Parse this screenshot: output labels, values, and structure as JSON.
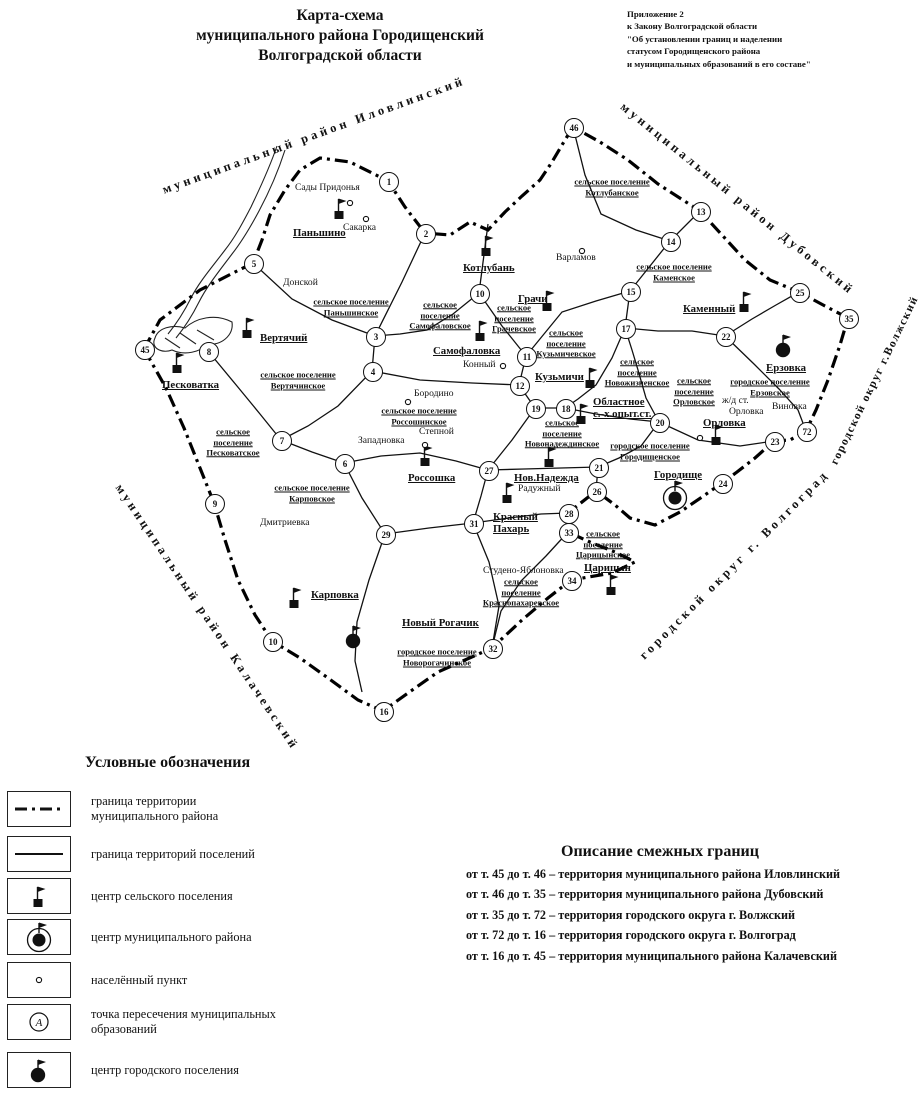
{
  "title": {
    "lines": [
      "Карта-схема",
      "муниципального района Городищенский",
      "Волгоградской области"
    ]
  },
  "annotation": {
    "lines": [
      "Приложение 2",
      "к Закону Волгоградской области",
      "\"Об установлении границ и наделении",
      "статусом Городищенского района",
      "и муниципальных образований в его составе\""
    ]
  },
  "map": {
    "neighbors": [
      {
        "label": "муниципальный район Иловлинский",
        "x": 163,
        "y": 183,
        "angle": -20,
        "small": false
      },
      {
        "label": "муниципальный район Дубовский",
        "x": 622,
        "y": 98,
        "angle": 39,
        "small": false
      },
      {
        "label": "городской округ г.Волжский",
        "x": 834,
        "y": 458,
        "angle": -64,
        "small": true
      },
      {
        "label": "городской округ г. Волгоград",
        "x": 642,
        "y": 650,
        "angle": -45,
        "small": false
      },
      {
        "label": "муниципальный район Калачевский",
        "x": 118,
        "y": 478,
        "angle": 56,
        "small": false
      }
    ],
    "area_labels": [
      {
        "text": "сельское поселение\nПаньшинское",
        "cx": 351,
        "cy": 307
      },
      {
        "text": "сельское\nпоселение\nСамофаловское",
        "cx": 440,
        "cy": 315
      },
      {
        "text": "сельское поселение\nКотлубанское",
        "cx": 612,
        "cy": 187
      },
      {
        "text": "сельское\nпоселение\nГрачевское",
        "cx": 514,
        "cy": 318
      },
      {
        "text": "сельское поселение\nКаменское",
        "cx": 674,
        "cy": 272
      },
      {
        "text": "сельское поселение\nВертячинское",
        "cx": 298,
        "cy": 380
      },
      {
        "text": "сельское\nпоселение\nПесковатское",
        "cx": 233,
        "cy": 442
      },
      {
        "text": "сельское поселение\nРоссошинское",
        "cx": 419,
        "cy": 416
      },
      {
        "text": "сельское\nпоселение\nКузьмичевское",
        "cx": 566,
        "cy": 343
      },
      {
        "text": "сельское\nпоселение\nНовожизненское",
        "cx": 637,
        "cy": 372
      },
      {
        "text": "сельское\nпоселение\nОрловское",
        "cx": 694,
        "cy": 391
      },
      {
        "text": "городское поселение\nЕрзовское",
        "cx": 770,
        "cy": 387
      },
      {
        "text": "сельское\nпоселение\nНовонадеждинское",
        "cx": 562,
        "cy": 433
      },
      {
        "text": "городское поселение\nГородищенское",
        "cx": 650,
        "cy": 451
      },
      {
        "text": "сельское поселение\nКарповское",
        "cx": 312,
        "cy": 493
      },
      {
        "text": "сельское\nпоселение\nКраснопахаревское",
        "cx": 521,
        "cy": 592
      },
      {
        "text": "сельское\nпоселение\nЦарицынское",
        "cx": 603,
        "cy": 544
      },
      {
        "text": "городское поселение\nНоворогачинское",
        "cx": 437,
        "cy": 657
      }
    ],
    "place_labels": [
      {
        "kind": "center",
        "text": "Паньшино",
        "x": 293,
        "y": 227
      },
      {
        "kind": "center",
        "text": "Котлубань",
        "x": 463,
        "y": 262
      },
      {
        "kind": "center",
        "text": "Грачи",
        "x": 518,
        "y": 293
      },
      {
        "kind": "center",
        "text": "Самофаловка",
        "x": 433,
        "y": 345
      },
      {
        "kind": "center",
        "text": "Вертячий",
        "x": 260,
        "y": 332
      },
      {
        "kind": "center",
        "text": "Песковатка",
        "x": 162,
        "y": 379
      },
      {
        "kind": "center",
        "text": "Каменный",
        "x": 683,
        "y": 303
      },
      {
        "kind": "center",
        "text": "Россошка",
        "x": 408,
        "y": 472
      },
      {
        "kind": "center",
        "text": "Кузьмичи",
        "x": 535,
        "y": 371
      },
      {
        "kind": "center",
        "text": "Областное\nс.-х.опыт.ст.",
        "x": 593,
        "y": 396
      },
      {
        "kind": "center",
        "text": "Орловка",
        "x": 703,
        "y": 417
      },
      {
        "kind": "center",
        "text": "Нов.Надежда",
        "x": 514,
        "y": 472
      },
      {
        "kind": "center",
        "text": "Красный\nПахарь",
        "x": 493,
        "y": 511
      },
      {
        "kind": "center",
        "text": "Карповка",
        "x": 311,
        "y": 589
      },
      {
        "kind": "center",
        "text": "Царицын",
        "x": 584,
        "y": 562
      },
      {
        "kind": "center",
        "text": "Городище",
        "x": 654,
        "y": 469
      },
      {
        "kind": "center",
        "text": "Ерзовка",
        "x": 766,
        "y": 362
      },
      {
        "kind": "center",
        "text": "Новый Рогачик",
        "x": 402,
        "y": 617
      },
      {
        "kind": "village",
        "text": "Сады Придонья",
        "x": 295,
        "y": 183
      },
      {
        "kind": "village",
        "text": "Сакарка",
        "x": 343,
        "y": 223
      },
      {
        "kind": "village",
        "text": "Донской",
        "x": 283,
        "y": 278
      },
      {
        "kind": "village",
        "text": "Варламов",
        "x": 556,
        "y": 253
      },
      {
        "kind": "village",
        "text": "Конный",
        "x": 463,
        "y": 360
      },
      {
        "kind": "village",
        "text": "Бородино",
        "x": 414,
        "y": 389
      },
      {
        "kind": "village",
        "text": "Западновка",
        "x": 358,
        "y": 436
      },
      {
        "kind": "village",
        "text": "Степной",
        "x": 419,
        "y": 427
      },
      {
        "kind": "village",
        "text": "Дмитриевка",
        "x": 260,
        "y": 518
      },
      {
        "kind": "village",
        "text": "Радужный",
        "x": 518,
        "y": 484
      },
      {
        "kind": "village",
        "text": "Студено-Яблоновка",
        "x": 483,
        "y": 566
      },
      {
        "kind": "village",
        "text": "Виновка",
        "x": 772,
        "y": 402
      },
      {
        "kind": "village",
        "text": "ж/д ст.",
        "x": 722,
        "y": 396
      },
      {
        "kind": "village",
        "text": "Орловка",
        "x": 729,
        "y": 407
      }
    ],
    "points": [
      {
        "n": "1",
        "x": 388,
        "y": 181
      },
      {
        "n": "2",
        "x": 425,
        "y": 233
      },
      {
        "n": "5",
        "x": 253,
        "y": 263
      },
      {
        "n": "3",
        "x": 375,
        "y": 336
      },
      {
        "n": "4",
        "x": 372,
        "y": 371
      },
      {
        "n": "45",
        "x": 144,
        "y": 349
      },
      {
        "n": "8",
        "x": 208,
        "y": 351
      },
      {
        "n": "7",
        "x": 281,
        "y": 440
      },
      {
        "n": "6",
        "x": 344,
        "y": 463
      },
      {
        "n": "9",
        "x": 214,
        "y": 503
      },
      {
        "n": "29",
        "x": 385,
        "y": 534
      },
      {
        "n": "10",
        "x": 272,
        "y": 641
      },
      {
        "n": "16",
        "x": 383,
        "y": 711
      },
      {
        "n": "32",
        "x": 492,
        "y": 648
      },
      {
        "n": "31",
        "x": 473,
        "y": 523
      },
      {
        "n": "27",
        "x": 488,
        "y": 470
      },
      {
        "n": "46",
        "x": 573,
        "y": 127
      },
      {
        "n": "13",
        "x": 700,
        "y": 211
      },
      {
        "n": "14",
        "x": 670,
        "y": 241
      },
      {
        "n": "15",
        "x": 630,
        "y": 291
      },
      {
        "n": "17",
        "x": 625,
        "y": 328
      },
      {
        "n": "10",
        "x": 479,
        "y": 293
      },
      {
        "n": "11",
        "x": 526,
        "y": 356
      },
      {
        "n": "12",
        "x": 519,
        "y": 385
      },
      {
        "n": "19",
        "x": 535,
        "y": 408
      },
      {
        "n": "18",
        "x": 565,
        "y": 408
      },
      {
        "n": "20",
        "x": 659,
        "y": 422
      },
      {
        "n": "21",
        "x": 598,
        "y": 467
      },
      {
        "n": "26",
        "x": 596,
        "y": 491
      },
      {
        "n": "28",
        "x": 568,
        "y": 513
      },
      {
        "n": "33",
        "x": 568,
        "y": 532
      },
      {
        "n": "34",
        "x": 571,
        "y": 580
      },
      {
        "n": "24",
        "x": 722,
        "y": 483
      },
      {
        "n": "23",
        "x": 774,
        "y": 441
      },
      {
        "n": "72",
        "x": 806,
        "y": 431
      },
      {
        "n": "35",
        "x": 848,
        "y": 318
      },
      {
        "n": "25",
        "x": 799,
        "y": 292
      },
      {
        "n": "22",
        "x": 725,
        "y": 336
      }
    ],
    "markers": [
      {
        "type": "rural-center",
        "x": 339,
        "y": 215
      },
      {
        "type": "rural-center",
        "x": 486,
        "y": 252
      },
      {
        "type": "rural-center",
        "x": 547,
        "y": 307
      },
      {
        "type": "rural-center",
        "x": 480,
        "y": 337
      },
      {
        "type": "rural-center",
        "x": 247,
        "y": 334
      },
      {
        "type": "rural-center",
        "x": 177,
        "y": 369
      },
      {
        "type": "rural-center",
        "x": 744,
        "y": 308
      },
      {
        "type": "rural-center",
        "x": 425,
        "y": 462
      },
      {
        "type": "rural-center",
        "x": 590,
        "y": 384
      },
      {
        "type": "rural-center",
        "x": 581,
        "y": 420
      },
      {
        "type": "rural-center",
        "x": 716,
        "y": 441
      },
      {
        "type": "rural-center",
        "x": 549,
        "y": 463
      },
      {
        "type": "rural-center",
        "x": 507,
        "y": 499
      },
      {
        "type": "rural-center",
        "x": 294,
        "y": 604
      },
      {
        "type": "rural-center",
        "x": 611,
        "y": 591
      },
      {
        "type": "town-center",
        "x": 783,
        "y": 350
      },
      {
        "type": "town-center",
        "x": 353,
        "y": 641
      },
      {
        "type": "district-center",
        "x": 675,
        "y": 498
      },
      {
        "type": "village",
        "x": 350,
        "y": 198
      },
      {
        "type": "village",
        "x": 366,
        "y": 214
      },
      {
        "type": "village",
        "x": 582,
        "y": 246
      },
      {
        "type": "village",
        "x": 503,
        "y": 361
      },
      {
        "type": "village",
        "x": 408,
        "y": 397
      },
      {
        "type": "village",
        "x": 425,
        "y": 440
      },
      {
        "type": "village",
        "x": 700,
        "y": 433
      }
    ]
  },
  "legend": {
    "title": "Условные обозначения",
    "items": [
      {
        "icon": "district-boundary-line-icon",
        "label": "граница территории\nмуниципального района"
      },
      {
        "icon": "settlement-boundary-line-icon",
        "label": "граница территорий поселений"
      },
      {
        "icon": "rural-center-flag-icon",
        "label": "центр сельского поселения"
      },
      {
        "icon": "district-center-symbol-icon",
        "label": "центр муниципального района"
      },
      {
        "icon": "village-dot-icon",
        "label": "населённый пункт"
      },
      {
        "icon": "intersection-point-icon",
        "label": "точка пересечения муниципальных\nобразований"
      },
      {
        "icon": "town-center-symbol-icon",
        "label": "центр городского поселения"
      }
    ]
  },
  "description": {
    "title": "Описание смежных границ",
    "lines": [
      "от т. 45 до т. 46 – территория муниципального района Иловлинский",
      "от т. 46 до т. 35 – территория муниципального района Дубовский",
      "от т. 35 до т. 72 – территория городского округа г. Волжский",
      "от т. 72 до т. 16 – территория городского округа г. Волгоград",
      "от т. 16 до т. 45 – территория муниципального района Калачевский"
    ]
  }
}
